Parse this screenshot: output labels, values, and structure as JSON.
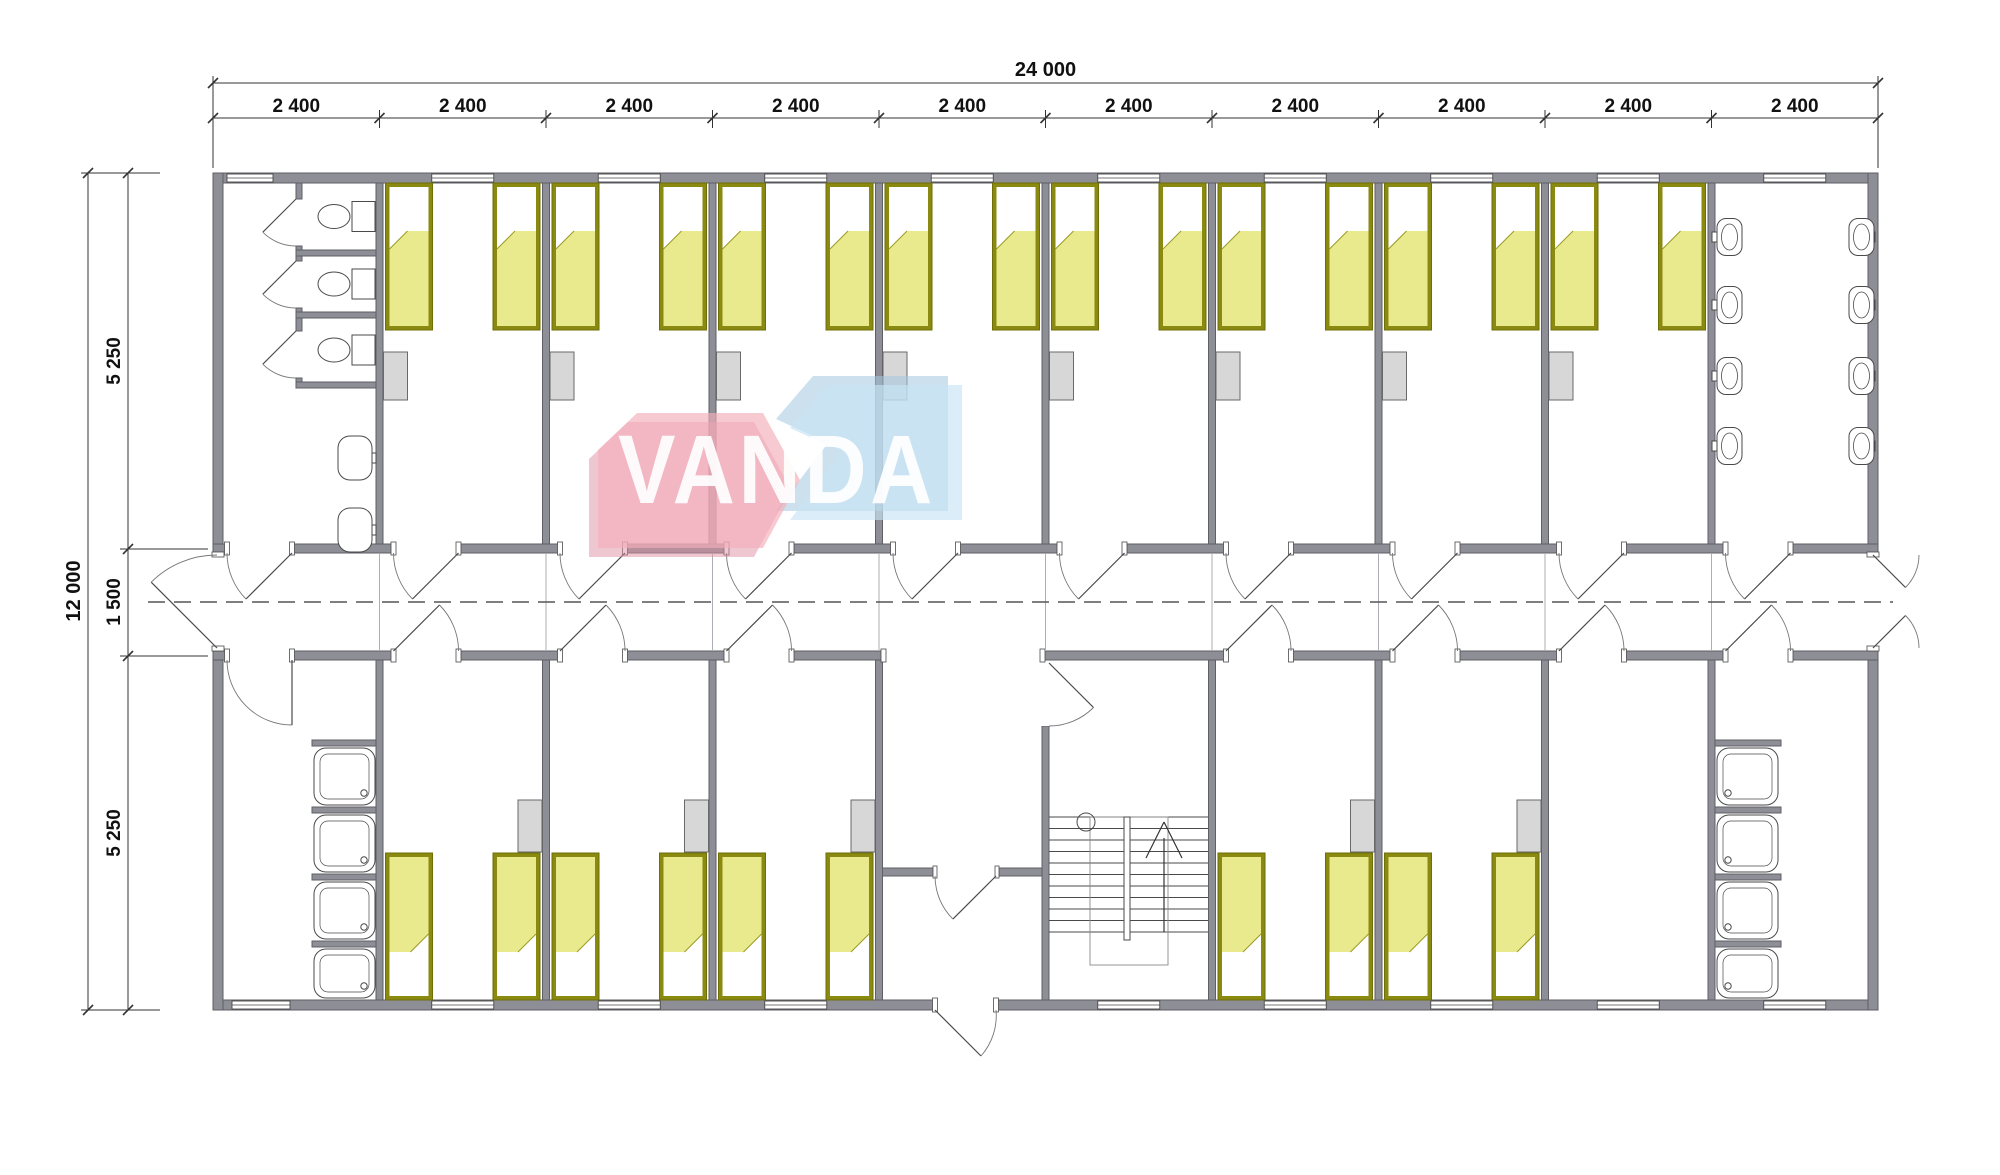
{
  "watermark": {
    "text": "VANDA",
    "text_color": "#ffffff",
    "pink": "#f3aeba",
    "pink_dark": "#e08fa4",
    "blue": "#c7e3f5",
    "blue_dark": "#a2c8de"
  },
  "dimensions": {
    "top_total": "24 000",
    "top_segments": [
      "2 400",
      "2 400",
      "2 400",
      "2 400",
      "2 400",
      "2 400",
      "2 400",
      "2 400",
      "2 400",
      "2 400"
    ],
    "left_total": "12 000",
    "left_segments": [
      "5 250",
      "1 500",
      "5 250"
    ]
  },
  "colors": {
    "wall_fill": "#8e8e97",
    "wall_border": "#5f5f66",
    "fixture_line": "#4a4a4a",
    "fixture_fill": "#ffffff",
    "bed_border": "#8a8a10",
    "bed_fill": "#e9e98e",
    "pillow": "#ffffff",
    "furniture_fill": "#d7d7d7",
    "furniture_border": "#6a6a6a",
    "dim_line": "#333333",
    "dim_text": "#111111",
    "dash_line": "#555555",
    "joint_line": "#aeaeb6",
    "door_line": "#4a4a4a",
    "arc_line": "#777777"
  },
  "plan_summary": {
    "modules": 10,
    "beds": 26,
    "toilets": 3,
    "wash_basins": 10,
    "showers": 8,
    "staircases": 1
  }
}
